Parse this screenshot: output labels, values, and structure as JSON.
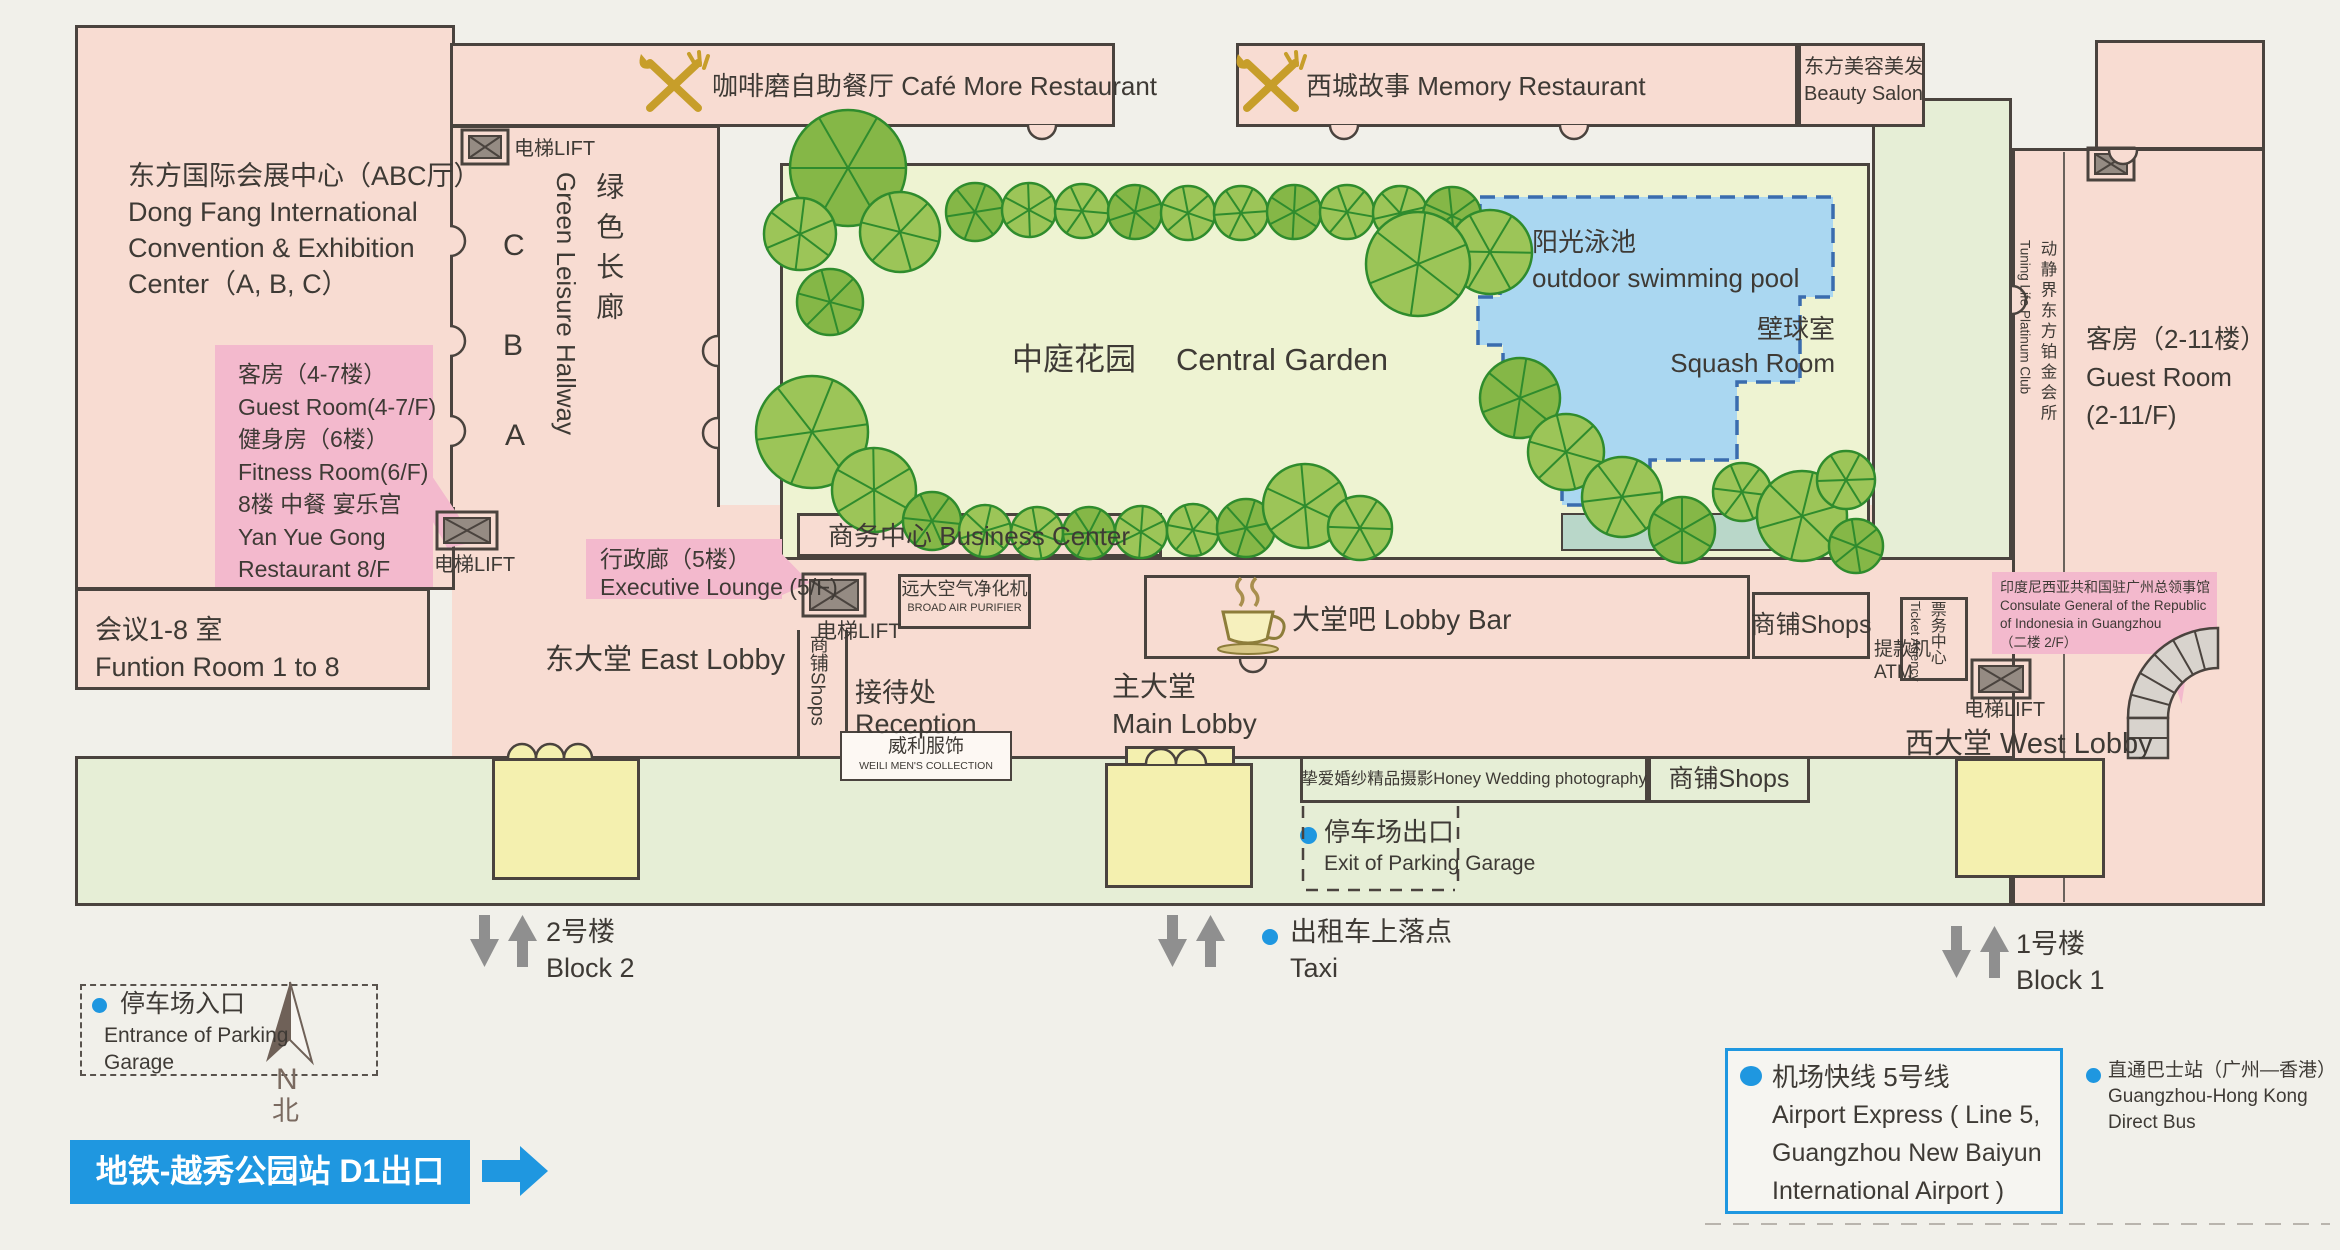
{
  "legend": {
    "lift": "电梯LIFT"
  },
  "left_building": {
    "line1": "东方国际会展中心（ABC厅）",
    "line2": "Dong Fang International",
    "line3": "Convention & Exhibition",
    "line4": "Center（A, B, C）",
    "callout": [
      "客房（4-7楼）",
      "Guest Room(4-7/F)",
      "健身房（6楼）",
      "Fitness Room(6/F)",
      "8楼 中餐 宴乐宫",
      "Yan Yue Gong",
      "Restaurant 8/F"
    ],
    "function1": "会议1-8 室",
    "function2": "Funtion Room 1 to 8",
    "doorC": "C",
    "doorB": "B",
    "doorA": "A"
  },
  "hallway": {
    "zh": "绿色长廊",
    "en": "Green Leisure Hallway"
  },
  "headers": {
    "cafe_zh": "咖啡磨自助餐厅",
    "cafe_en": "Café More Restaurant",
    "memory_zh": "西城故事",
    "memory_en": "Memory Restaurant",
    "beauty_zh": "东方美容美发",
    "beauty_en": "Beauty Salon"
  },
  "garden": {
    "zh": "中庭花园",
    "en": "Central Garden",
    "pool_zh": "阳光泳池",
    "pool_en": "outdoor swimming pool",
    "squash_zh": "壁球室",
    "squash_en": "Squash Room",
    "pool_points": "1480,197 1833,197 1833,297 1800,297 1800,382 1737,382 1737,460 1650,460 1650,505 1562,505 1562,455 1530,455 1530,400 1503,400 1503,345 1478,345 1478,297 1500,297 1500,255 1480,255",
    "trees": [
      [
        848,
        168,
        58
      ],
      [
        800,
        234,
        36
      ],
      [
        900,
        232,
        40
      ],
      [
        975,
        212,
        29
      ],
      [
        1029,
        210,
        27
      ],
      [
        1082,
        211,
        27
      ],
      [
        1135,
        212,
        27
      ],
      [
        1188,
        213,
        27
      ],
      [
        1241,
        213,
        27
      ],
      [
        1294,
        212,
        27
      ],
      [
        1347,
        212,
        27
      ],
      [
        1400,
        213,
        27
      ],
      [
        1452,
        216,
        29
      ],
      [
        1490,
        252,
        42
      ],
      [
        1418,
        264,
        52
      ],
      [
        830,
        302,
        33
      ],
      [
        812,
        432,
        56
      ],
      [
        874,
        490,
        42
      ],
      [
        932,
        521,
        29
      ],
      [
        985,
        531,
        26
      ],
      [
        1037,
        533,
        26
      ],
      [
        1089,
        533,
        26
      ],
      [
        1141,
        532,
        26
      ],
      [
        1193,
        530,
        26
      ],
      [
        1246,
        528,
        29
      ],
      [
        1305,
        506,
        42
      ],
      [
        1360,
        528,
        32
      ],
      [
        1520,
        398,
        40
      ],
      [
        1566,
        452,
        38
      ],
      [
        1622,
        497,
        40
      ],
      [
        1682,
        530,
        33
      ],
      [
        1742,
        492,
        29
      ],
      [
        1802,
        516,
        45
      ],
      [
        1856,
        546,
        27
      ],
      [
        1846,
        480,
        29
      ]
    ]
  },
  "center": {
    "business": "商务中心 Business Center",
    "exec1": "行政廊（5楼）",
    "exec2": "Executive Lounge (5/F)",
    "purifier_zh": "远大空气净化机",
    "purifier_en": "BROAD AIR PURIFIER",
    "east_lobby": "东大堂 East Lobby",
    "reception_zh": "接待处",
    "reception_en": "Reception",
    "shops_v": "商铺Shops",
    "weili_zh": "威利服饰",
    "weili_en": "WEILI MEN'S COLLECTION",
    "main_zh": "主大堂",
    "main_en": "Main Lobby",
    "lobbybar": "大堂吧 Lobby Bar",
    "shops1": "商铺Shops",
    "atm_zh": "提款机",
    "atm_en": "ATM"
  },
  "west": {
    "ticket_zh": "票务中心",
    "ticket_en": "Ticket Agency",
    "consulate": [
      "印度尼西亚共和国驻广州总领事馆",
      "Consulate General of the Republic",
      "of Indonesia in Guangzhou",
      "（二楼 2/F）"
    ],
    "west_lobby": "西大堂 West Lobby"
  },
  "right": {
    "club_zh": "动静界东方铂金会所",
    "club_en": "Tuning Life Platinum Club",
    "guest_zh": "客房（2-11楼）",
    "guest_en1": "Guest Room",
    "guest_en2": "(2-11/F)"
  },
  "south": {
    "honey": "挚爱婚纱精品摄影Honey Wedding photography",
    "shops2": "商铺Shops",
    "exit_zh": "停车场出口",
    "exit_en": "Exit of Parking Garage",
    "block2_zh": "2号楼",
    "block2_en": "Block 2",
    "taxi_zh": "出租车上落点",
    "taxi_en": "Taxi",
    "block1_zh": "1号楼",
    "block1_en": "Block 1",
    "entrance_zh": "停车场入口",
    "entrance_en1": "Entrance of Parking",
    "entrance_en2": "Garage",
    "compass_n": "N",
    "compass_bei": "北",
    "metro": "地铁-越秀公园站 D1出口",
    "airport": [
      "机场快线 5号线",
      "Airport Express ( Line 5,",
      "Guangzhou New Baiyun",
      "International Airport )"
    ],
    "hkbus": [
      "直通巴士站（广州—香港）",
      "Guangzhou-Hong Kong",
      "Direct Bus"
    ]
  }
}
